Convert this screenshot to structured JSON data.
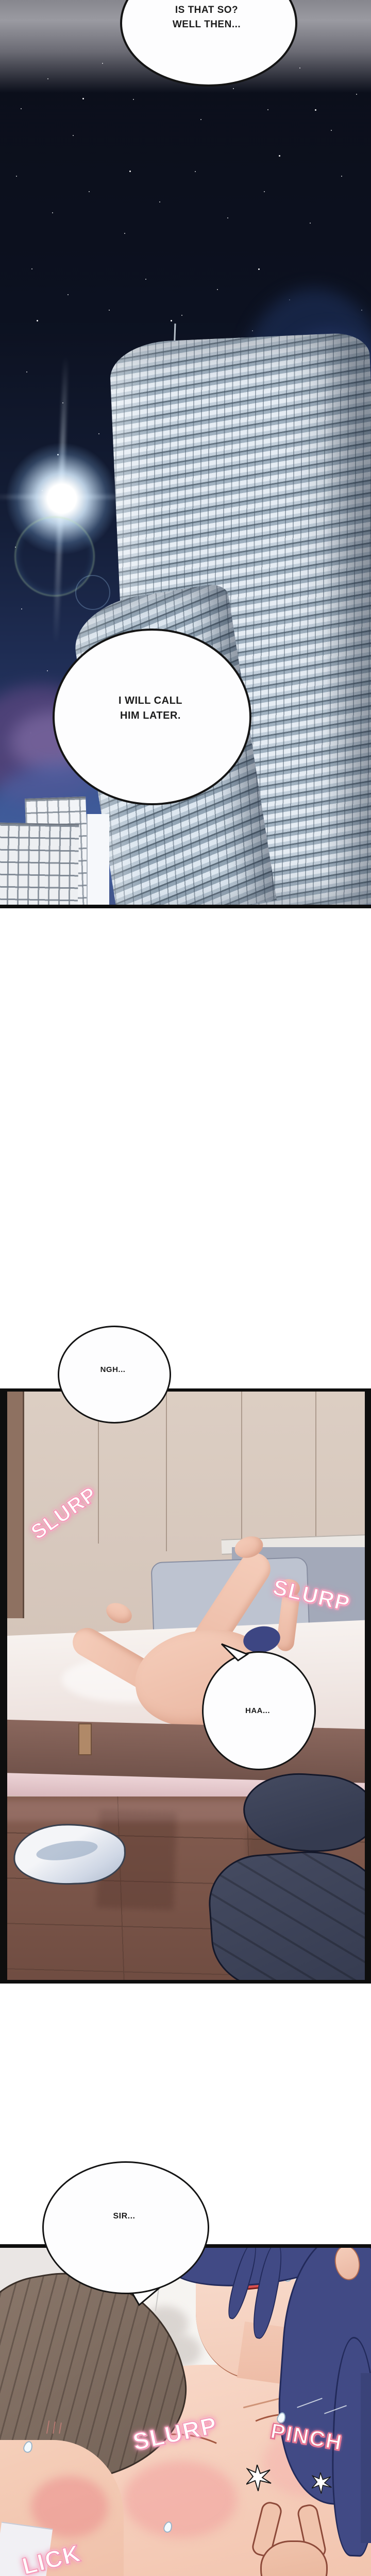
{
  "speech_bubbles": {
    "b1": {
      "line1": "IS THAT SO?",
      "line2": "WELL THEN..."
    },
    "b2": {
      "line1": "I WILL CALL",
      "line2": "HIM LATER."
    },
    "b3": {
      "text": "NGH..."
    },
    "b4": {
      "text": "HAA..."
    },
    "b5": {
      "text": "SIR..."
    }
  },
  "sfx": {
    "slurp_bedroom_left": "SLURP",
    "slurp_bedroom_right": "SLURP",
    "slurp_closeup": "SLURP",
    "pinch": "PINCH",
    "lick": "LICK"
  },
  "colors": {
    "bubble_border": "#141414",
    "sfx_fill": "#ffffff",
    "sfx_glow_pink": "#f07ba6",
    "night_sky": "#0b0e19",
    "tower_glass": "#c2cfdb",
    "bedroom_wall": "#d9cbc0",
    "wood_floor": "#7b564b",
    "clothes_navy": "#3d4358",
    "skin_tone": "#f4cdba",
    "hair_indigo": "#414a85",
    "hair_brown": "#7f6a5e",
    "mouth_red": "#d94f4f"
  }
}
